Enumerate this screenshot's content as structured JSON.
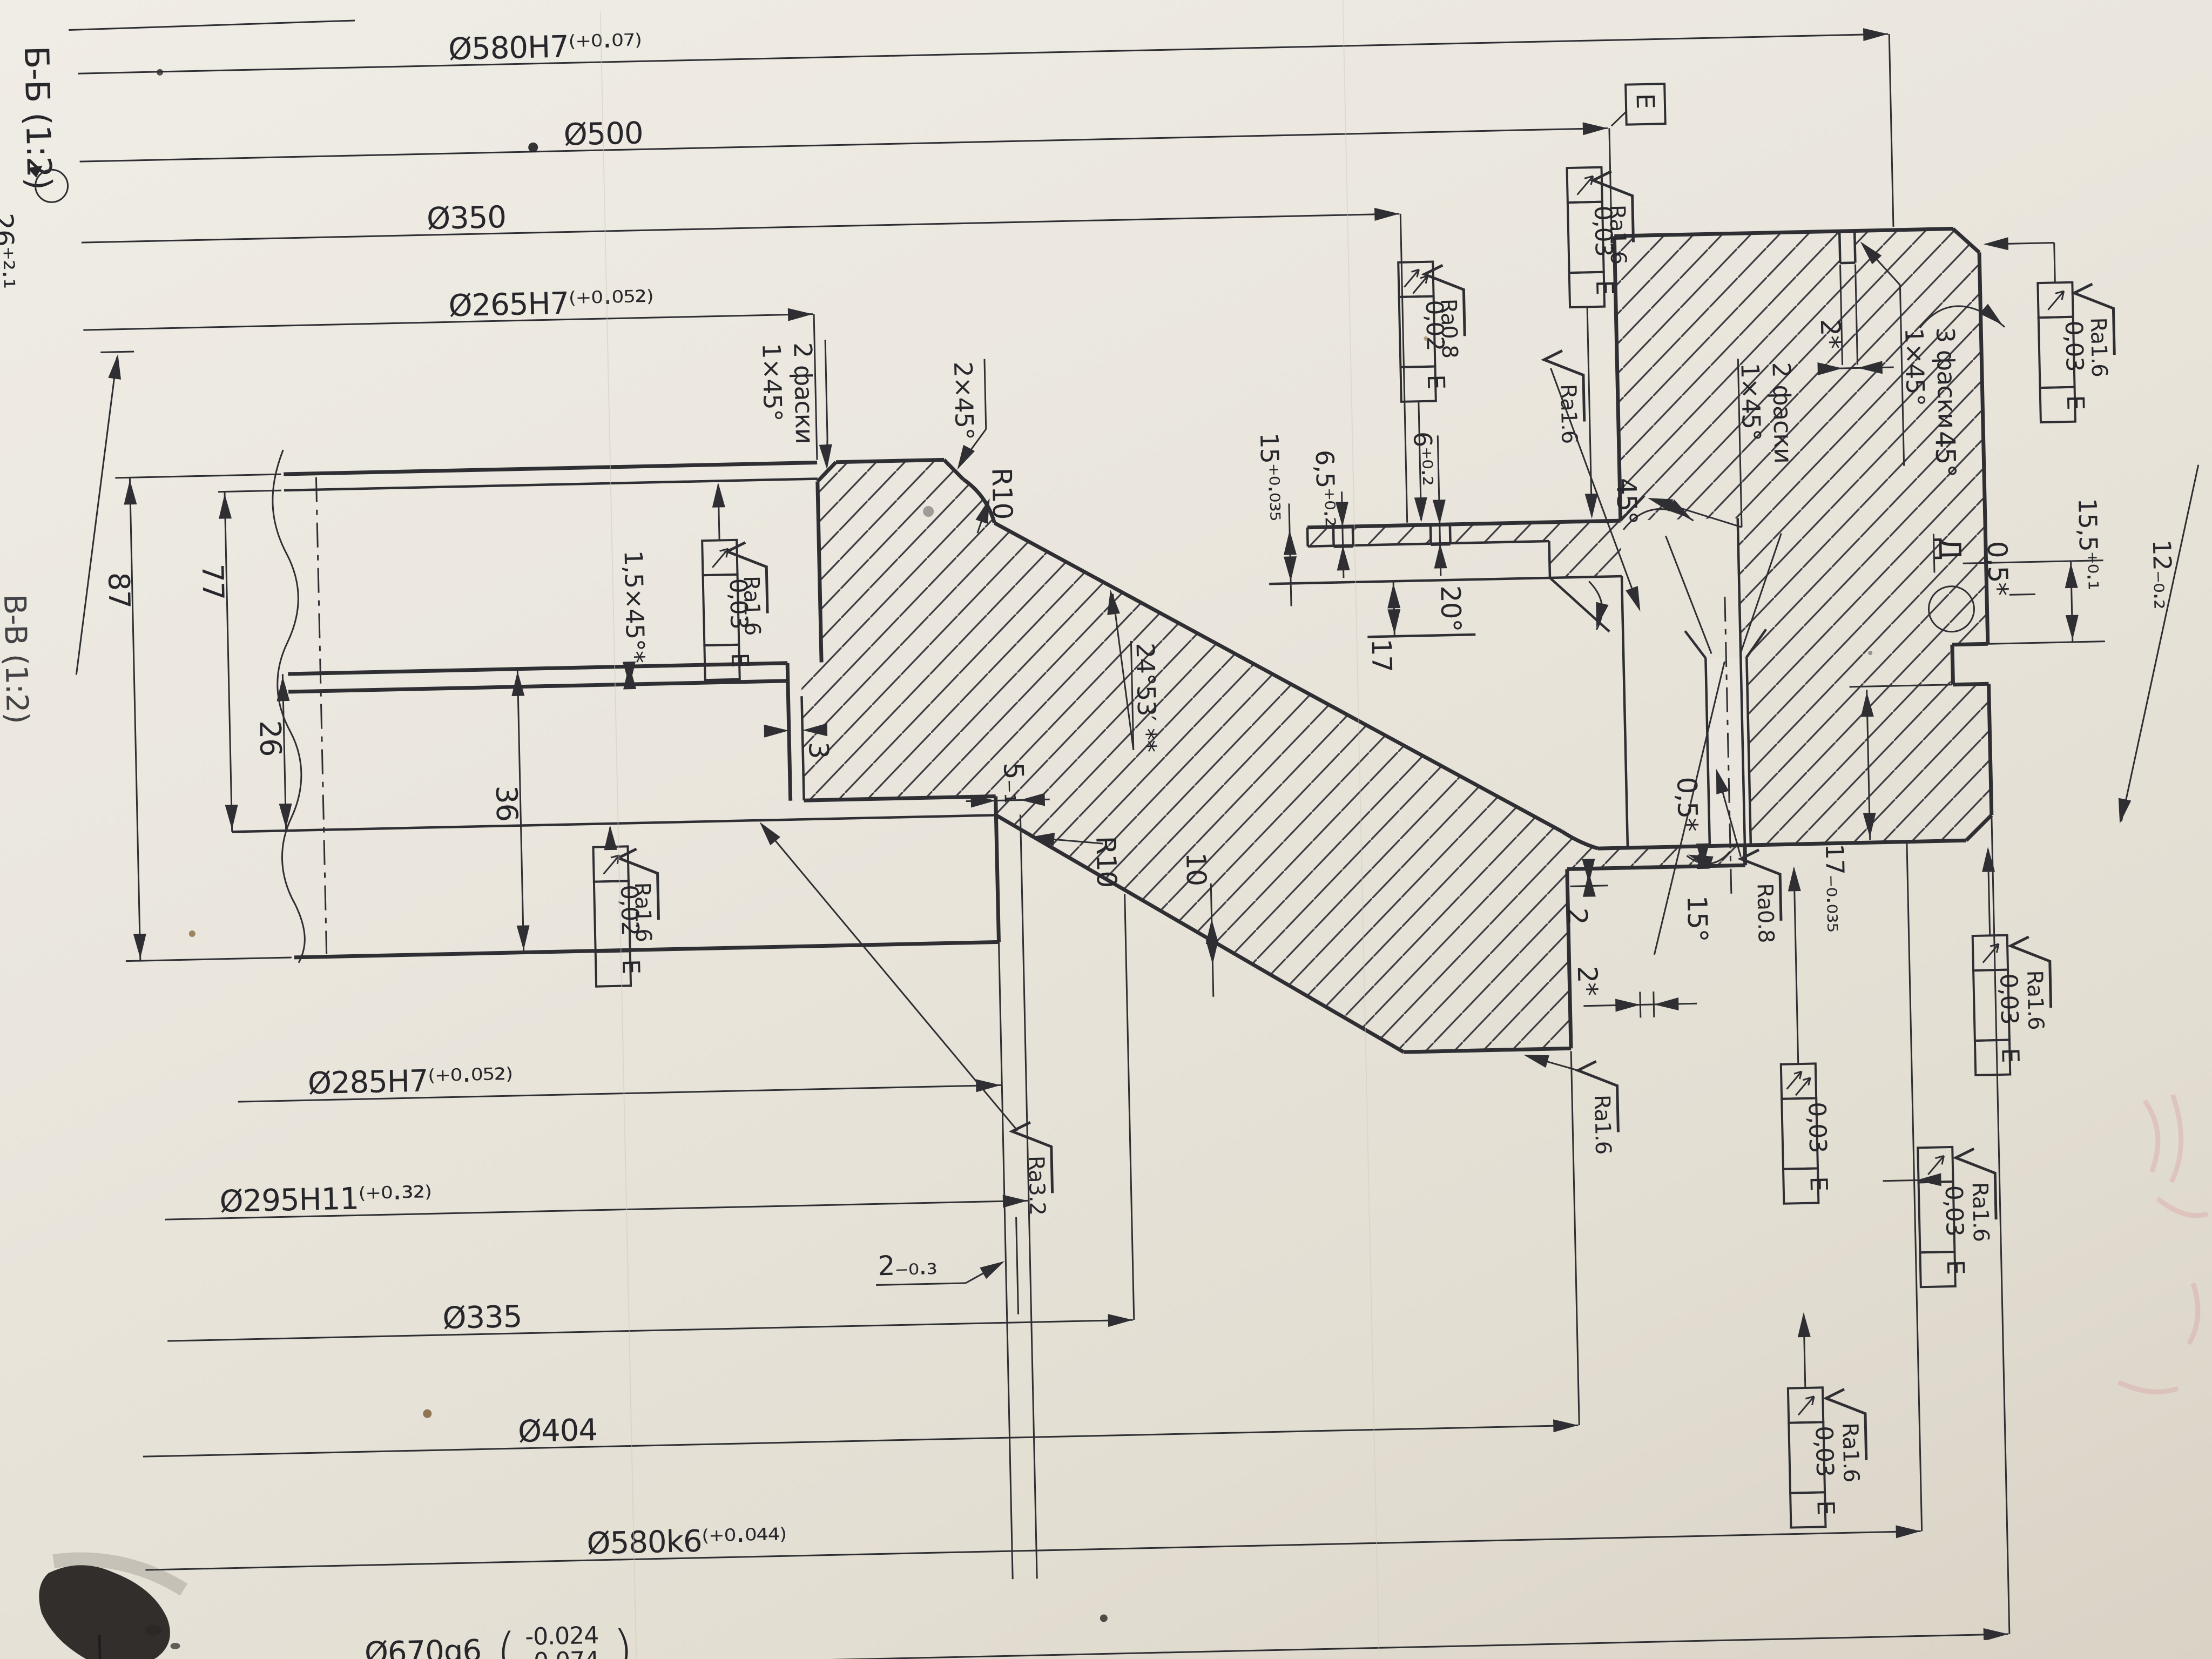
{
  "drawing": {
    "section_label": "Б-Б (1:2)",
    "section_label_2": "В-В (1:2)",
    "corner_dim": "26⁺²·¹",
    "datum_letter": "E",
    "view_letter": "Д",
    "top_dims": {
      "d580h7": "Ø580H7⁽⁺⁰·⁰⁷⁾",
      "d500": "Ø500",
      "d350": "Ø350",
      "d265": "Ø265H7⁽⁺⁰·⁰⁵²⁾"
    },
    "bottom_dims": {
      "d285": "Ø285H7⁽⁺⁰·⁰⁵²⁾",
      "d295": "Ø295H11⁽⁺⁰·³²⁾",
      "d335": "Ø335",
      "d404": "Ø404",
      "d580k6": "Ø580k6⁽⁺⁰·⁰⁴⁴⁾",
      "d670_main": "Ø670g6",
      "d670_upper": "-0.024",
      "d670_lower": "-0.074",
      "paren_open": "(",
      "paren_close": ")"
    },
    "left_dims": {
      "h87": "87",
      "h77": "77",
      "h26": "26",
      "h36": "36"
    },
    "small_dims": {
      "s3": "3",
      "s5": "5₋₁",
      "s2_03": "2₋₀.₃",
      "s10": "10",
      "s17": "17",
      "a20": "20°",
      "a24": "24°53′ **",
      "s15t": "15⁺⁰·⁰³⁵",
      "s65": "6,5⁺⁰·²",
      "s6": "6⁺⁰·²",
      "s2": "2",
      "s2star_r": "2*",
      "a15": "15°",
      "s05_r": "0,5*",
      "s05_t": "0,5*",
      "s155": "15,5⁺⁰·¹",
      "s17t": "17₋₀.₀₃₅",
      "s12": "12₋₀.₂",
      "s2star_t": "2*",
      "a45_1": "45°",
      "a45_2": "45°",
      "r10a": "R10",
      "r10b": "R10",
      "ch15": "1,5×45°*"
    },
    "chamfer_notes": {
      "n1_line1": "1×45°",
      "n1_line2": "2 фаски",
      "n2": "2×45°",
      "n3_line1": "1×45°",
      "n3_line2": "3 фаски",
      "n4_line1": "1×45°",
      "n4_line2": "2 фаски"
    },
    "roughness": {
      "ra16": "Ra1.6",
      "ra08": "Ra0.8",
      "ra32": "Ra3.2"
    },
    "tolerance_frames": {
      "v003": "0,03",
      "v002": "0,02",
      "datum": "E"
    }
  }
}
